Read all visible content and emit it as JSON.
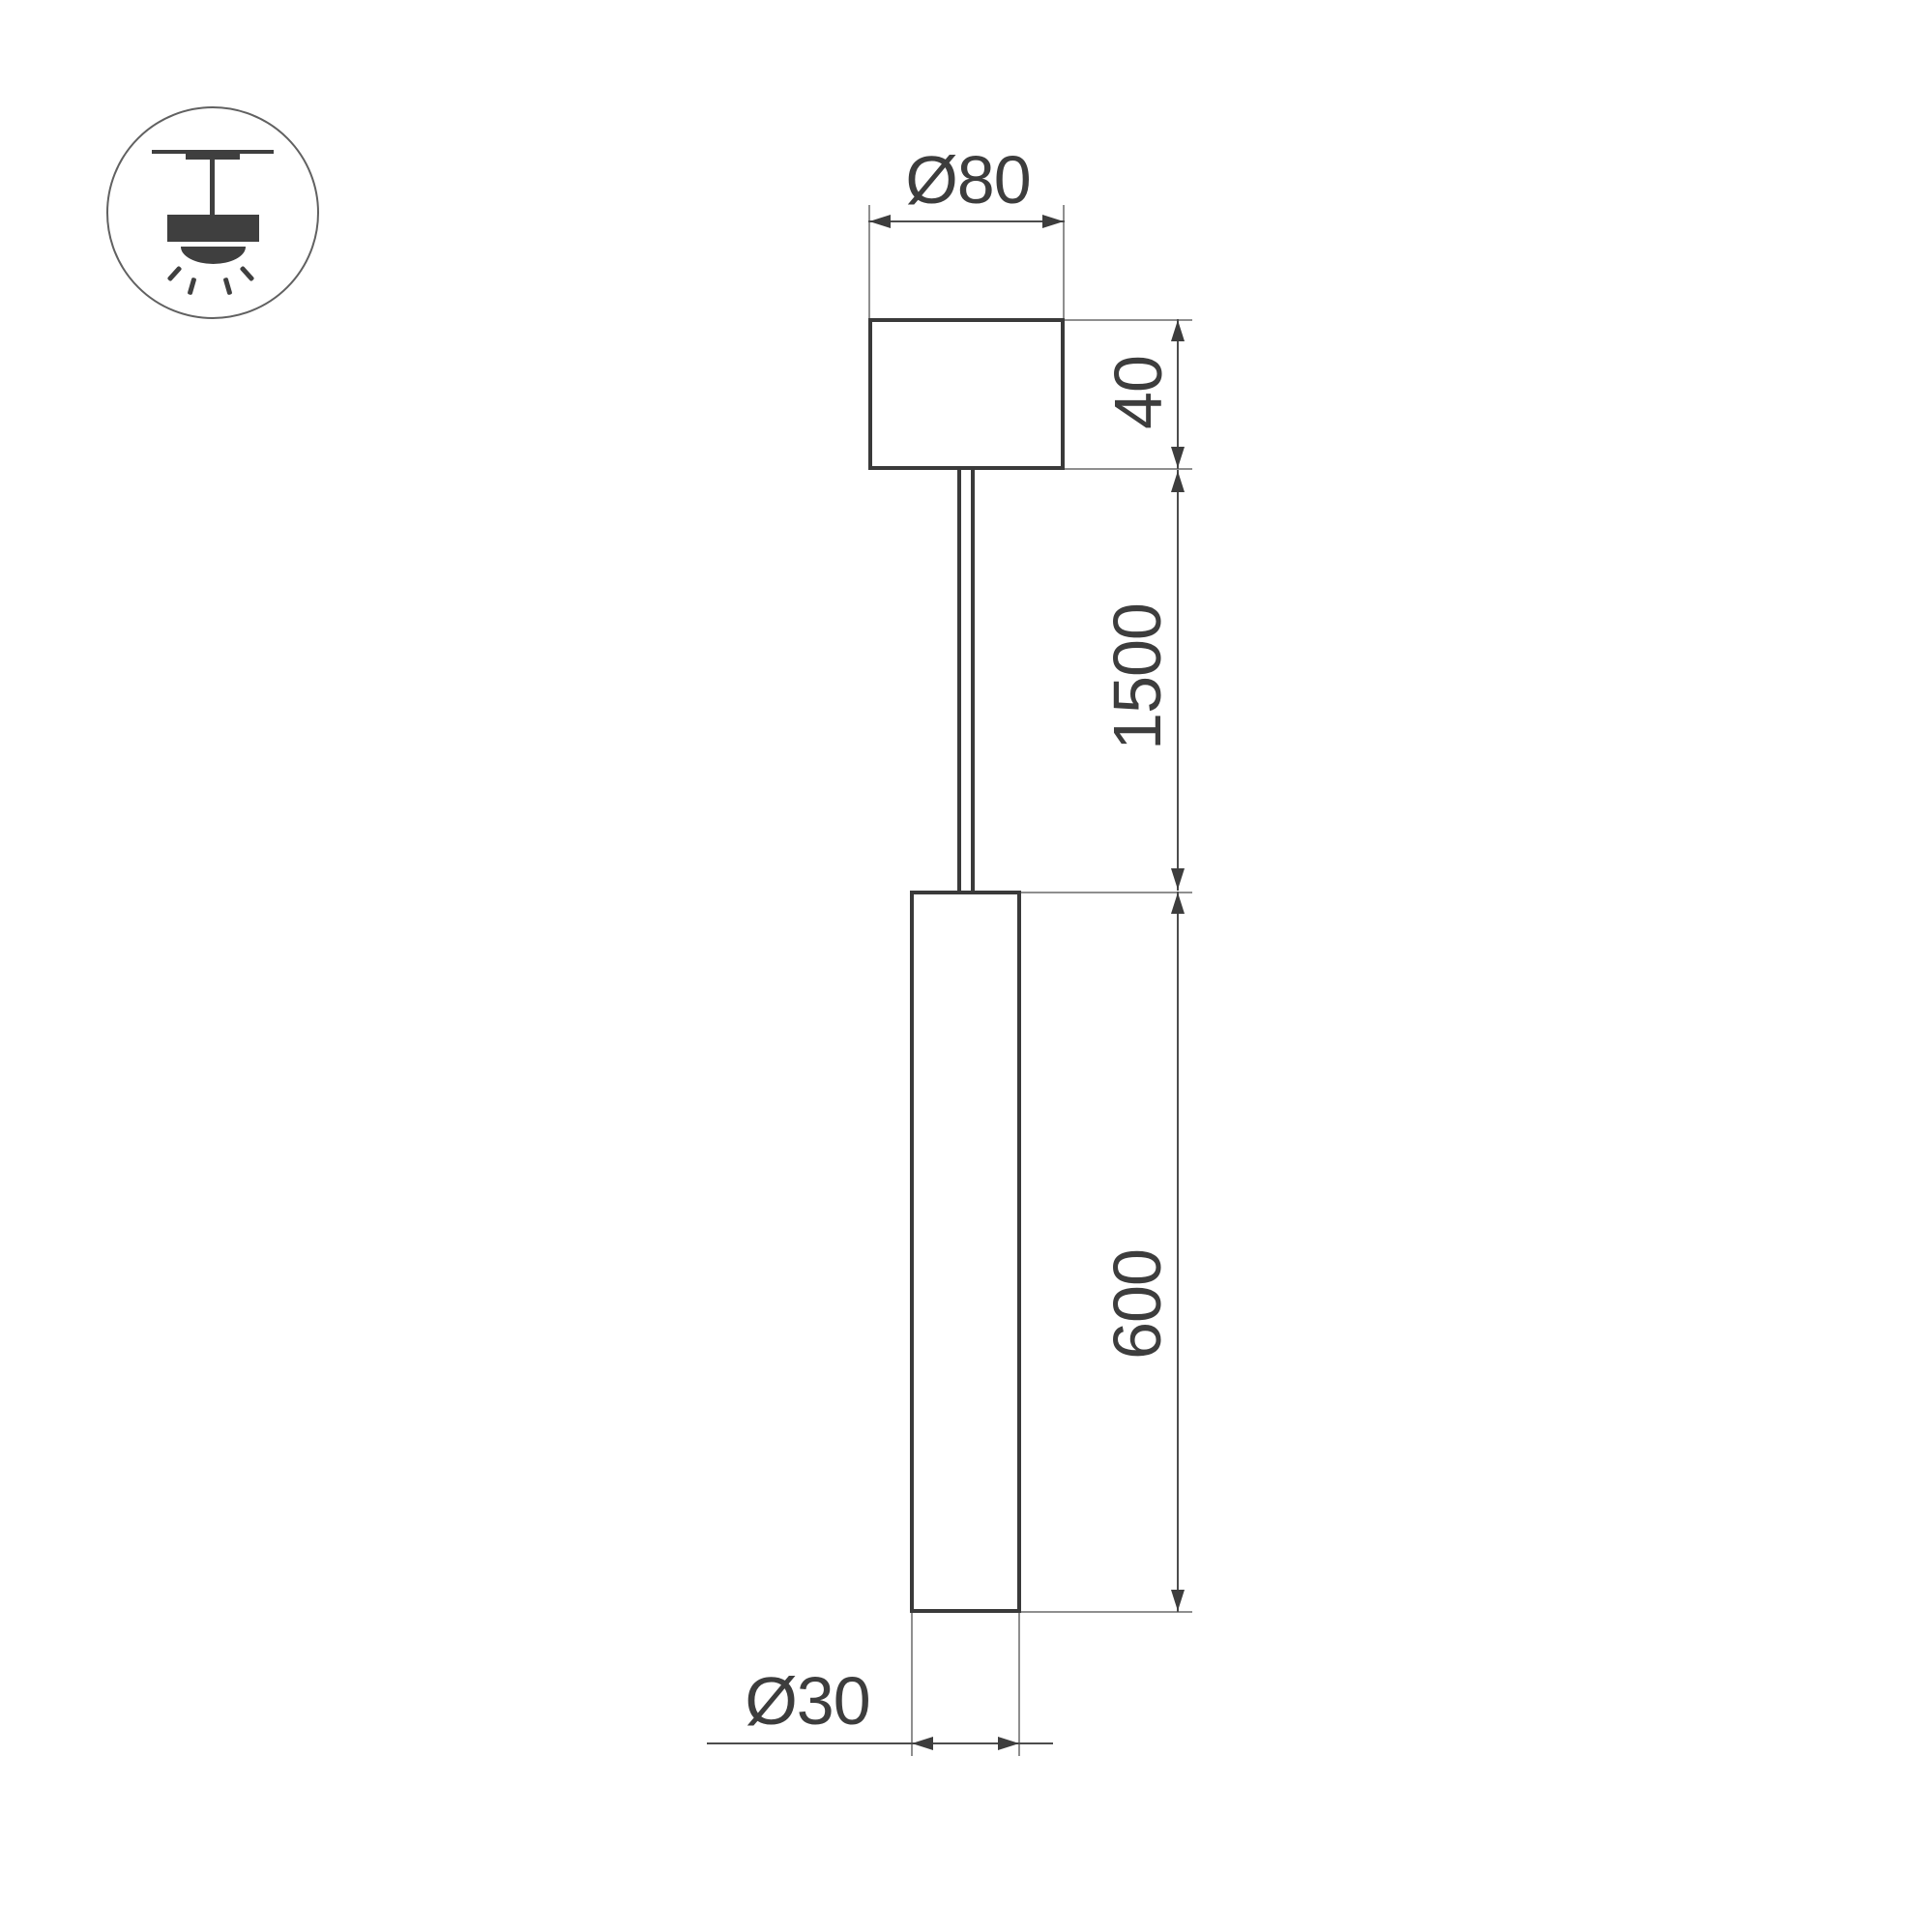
{
  "drawing": {
    "type": "pendant-lamp-dimension-drawing",
    "icons": {
      "mount_type": "ceiling-pendant-icon"
    },
    "dimensions": {
      "canopy_diameter": "Ø80",
      "canopy_height": "40",
      "suspension_length": "1500",
      "tube_length": "600",
      "tube_diameter": "Ø30"
    },
    "colors": {
      "object_outline": "#3a3a3a",
      "dimension_line": "#4d4d4d",
      "extension_line": "#8f8f8f",
      "text": "#3d3d3d",
      "icon_fill": "#3f3f3f",
      "background": "#ffffff"
    }
  }
}
